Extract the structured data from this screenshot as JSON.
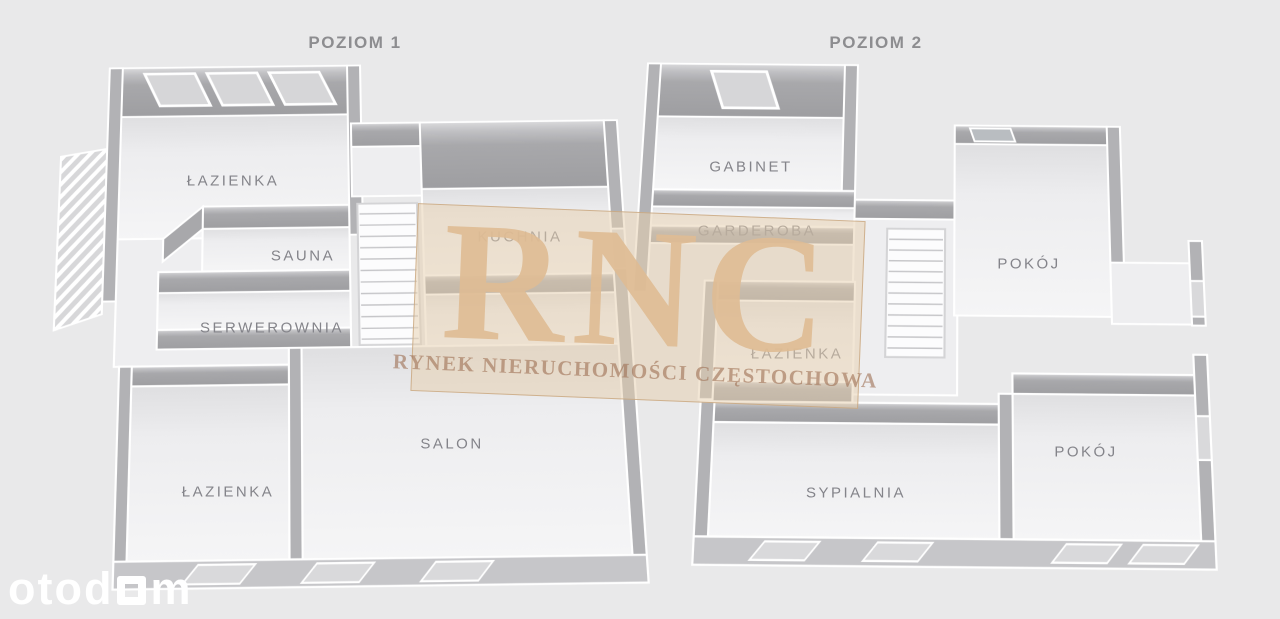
{
  "levels": {
    "poziom1": {
      "title": "POZIOM 1",
      "rooms": {
        "lazienka_top": "ŁAZIENKA",
        "sauna": "SAUNA",
        "serwerownia": "SERWEROWNIA",
        "kuchnia": "KUCHNIA",
        "salon": "SALON",
        "lazienka_bottom": "ŁAZIENKA"
      }
    },
    "poziom2": {
      "title": "POZIOM 2",
      "rooms": {
        "gabinet": "GABINET",
        "garderoba": "GARDEROBA",
        "lazienka": "ŁAZIENKA",
        "pokoj_gorny": "POKÓJ",
        "pokoj_dolny": "POKÓJ",
        "sypialnia": "SYPIALNIA"
      }
    }
  },
  "watermark": {
    "initials": "RNC",
    "tagline": "RYNEK NIERUCHOMOŚCI CZĘSTOCHOWA",
    "box_color": "#e7d0af",
    "letters_color": "#debd92",
    "tagline_color": "#9c6e52"
  },
  "brand": {
    "prefix": "otod",
    "suffix": "m",
    "color": "#ffffff"
  },
  "palette": {
    "background": "#e9e9ea",
    "wall_gray": "#a9a9ac",
    "wall_light": "#c6c6c9",
    "floor": "#f2f2f3",
    "label_text": "#84848a",
    "title_text": "#8d8d90"
  }
}
